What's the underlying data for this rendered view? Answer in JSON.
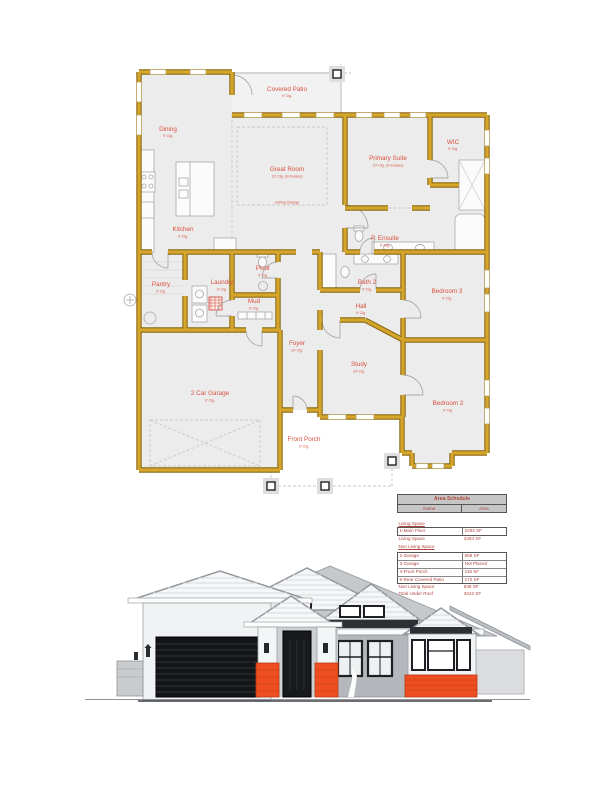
{
  "palette": {
    "wall_gold": "#d6a62c",
    "wall_outline": "#8a6a14",
    "room_fill": "#ececec",
    "label_red": "#d9503f",
    "table_red": "#b0453a",
    "table_header_gray": "#c6c6c6",
    "brick_orange": "#ef4e20",
    "dark_trim": "#17191c",
    "roof_gray": "#c6c9cc"
  },
  "floor_plan": {
    "rooms": [
      {
        "name": "Covered Patio",
        "ceiling": "9' Clg."
      },
      {
        "name": "Dining",
        "ceiling": "9' Clg."
      },
      {
        "name": "Great Room",
        "ceiling": "10' Clg. (in trusses)"
      },
      {
        "name": "Primary Suite",
        "ceiling": "10' Clg. (in trusses)"
      },
      {
        "name": "WIC",
        "ceiling": "9' Clg."
      },
      {
        "name": "Kitchen",
        "ceiling": "9' Clg."
      },
      {
        "name": "P. Ensuite",
        "ceiling": "9' Clg."
      },
      {
        "name": "Pantry",
        "ceiling": "9' Clg."
      },
      {
        "name": "Laundry",
        "ceiling": "9' Clg."
      },
      {
        "name": "Pwdr",
        "ceiling": "9' Clg."
      },
      {
        "name": "Mud",
        "ceiling": "9' Clg."
      },
      {
        "name": "Bath 2",
        "ceiling": "9' Clg."
      },
      {
        "name": "Hall",
        "ceiling": "9' Clg."
      },
      {
        "name": "Bedroom 3",
        "ceiling": "9' Clg."
      },
      {
        "name": "Foyer",
        "ceiling": "14' Clg."
      },
      {
        "name": "Study",
        "ceiling": "14' Clg."
      },
      {
        "name": "Bedroom 2",
        "ceiling": "9' Clg."
      },
      {
        "name": "2 Car Garage",
        "ceiling": "9' Clg."
      },
      {
        "name": "Front Porch",
        "ceiling": "9' Clg."
      }
    ],
    "annotations": {
      "ceiling_change": "Ceiling Change"
    }
  },
  "area_schedule": {
    "title": "Area Schedule",
    "columns": [
      "Name",
      "Area"
    ],
    "rows": [
      {
        "name": "Living Space",
        "area": ""
      },
      {
        "name": "1-Main Floor",
        "area": "2294 SF"
      },
      {
        "name": "Living Space",
        "area": "2294 SF"
      },
      {
        "name": "Non Living Space",
        "area": ""
      },
      {
        "name": "2-Garage",
        "area": "658 SF"
      },
      {
        "name": "3-Garage",
        "area": "Not Placed"
      },
      {
        "name": "4-Front Porch",
        "area": "118 SF"
      },
      {
        "name": "5-Rear Covered Patio",
        "area": "172 SF"
      },
      {
        "name": "Non Living Space",
        "area": "948 SF"
      },
      {
        "name": "Total Under Roof",
        "area": "3242 SF"
      }
    ]
  }
}
